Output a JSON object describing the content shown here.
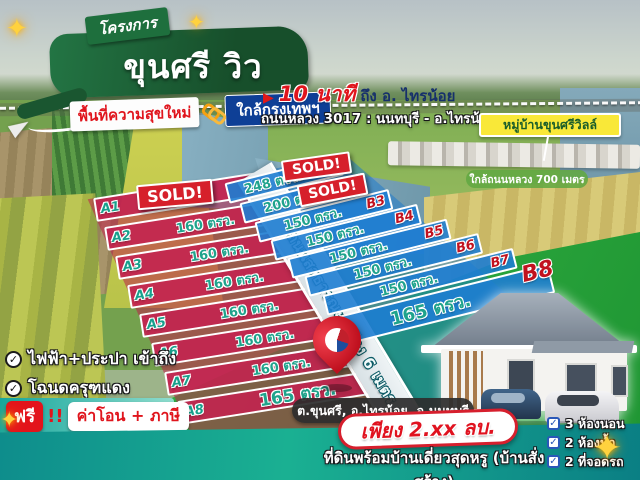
{
  "colors": {
    "header_green": "#1a5c33",
    "accent_blue": "#0e3f96",
    "accent_red": "#e0151d",
    "plot_red": "#c42250",
    "plot_blue": "#1e7dd2",
    "teal_band": "#12a49a",
    "label_teal": "#1fa38c",
    "sold_red": "#d6202b",
    "deed_yellow": "#f9e838"
  },
  "icons": {
    "play": "▶",
    "phone": "☎",
    "check": "✓",
    "sparkle": "✦",
    "colon": ":"
  },
  "header": {
    "ribbon": "โครงการ",
    "title": "ขุนศรี วิว",
    "tag_new": "พื้นที่ความสุขใหม่",
    "tag_near": "ใกล้กรุงเทพฯ"
  },
  "map_notes": {
    "minutes": "10 นาที",
    "minutes_to": "ถึง อ. ไทรน้อย",
    "highway": "ถนนหลวง 3017 : นนทบุรี - อ.ไทรน้อย",
    "village": "หมู่บ้านขุนศรีวิลล์",
    "near_highway": "ใกล้ถนนหลวง 700 เมตร",
    "road": "ถนนสาธารณะ กว้าง 6 เมตร",
    "sold": "SOLD!"
  },
  "plots_a": [
    {
      "label": "A1",
      "size": ""
    },
    {
      "label": "A2",
      "size": "160 ตรว."
    },
    {
      "label": "A3",
      "size": "160 ตรว."
    },
    {
      "label": "A4",
      "size": "160 ตรว."
    },
    {
      "label": "A5",
      "size": "160 ตรว."
    },
    {
      "label": "A6",
      "size": "160 ตรว."
    },
    {
      "label": "A7",
      "size": "160 ตรว."
    },
    {
      "label": "A8",
      "size": "165 ตรว."
    }
  ],
  "plots_b": [
    {
      "label": "B1",
      "size": "248 ตรว."
    },
    {
      "label": "B2",
      "size": "200 ตรว."
    },
    {
      "label": "B3",
      "size": "150 ตรว."
    },
    {
      "label": "B4",
      "size": "150 ตรว."
    },
    {
      "label": "B5",
      "size": "150 ตรว."
    },
    {
      "label": "B6",
      "size": "150 ตรว."
    },
    {
      "label": "B7",
      "size": "150 ตรว."
    },
    {
      "label": "B8",
      "size": "165 ตรว."
    }
  ],
  "perks": [
    "ไฟฟ้า+ประปา เข้าถึง",
    "โฉนดครุฑแดง"
  ],
  "free_banner": {
    "free": "ฟรี",
    "bang": "!!",
    "items": "ค่าโอน + ภาษี"
  },
  "price_per_wah": "5,900 บ./ตรว.",
  "location": "ต.ขุนศรี, อ.ไทรน้อย, จ.นนทบุรี",
  "offer": {
    "price": "เพียง 2.xx ลบ.",
    "description": "ที่ดินพร้อมบ้านเดี่ยวสุดหรู (บ้านสั่งสร้าง)"
  },
  "house_specs": [
    "3 ห้องนอน",
    "2 ห้องน้ำ",
    "2 ที่จอดรถ"
  ]
}
